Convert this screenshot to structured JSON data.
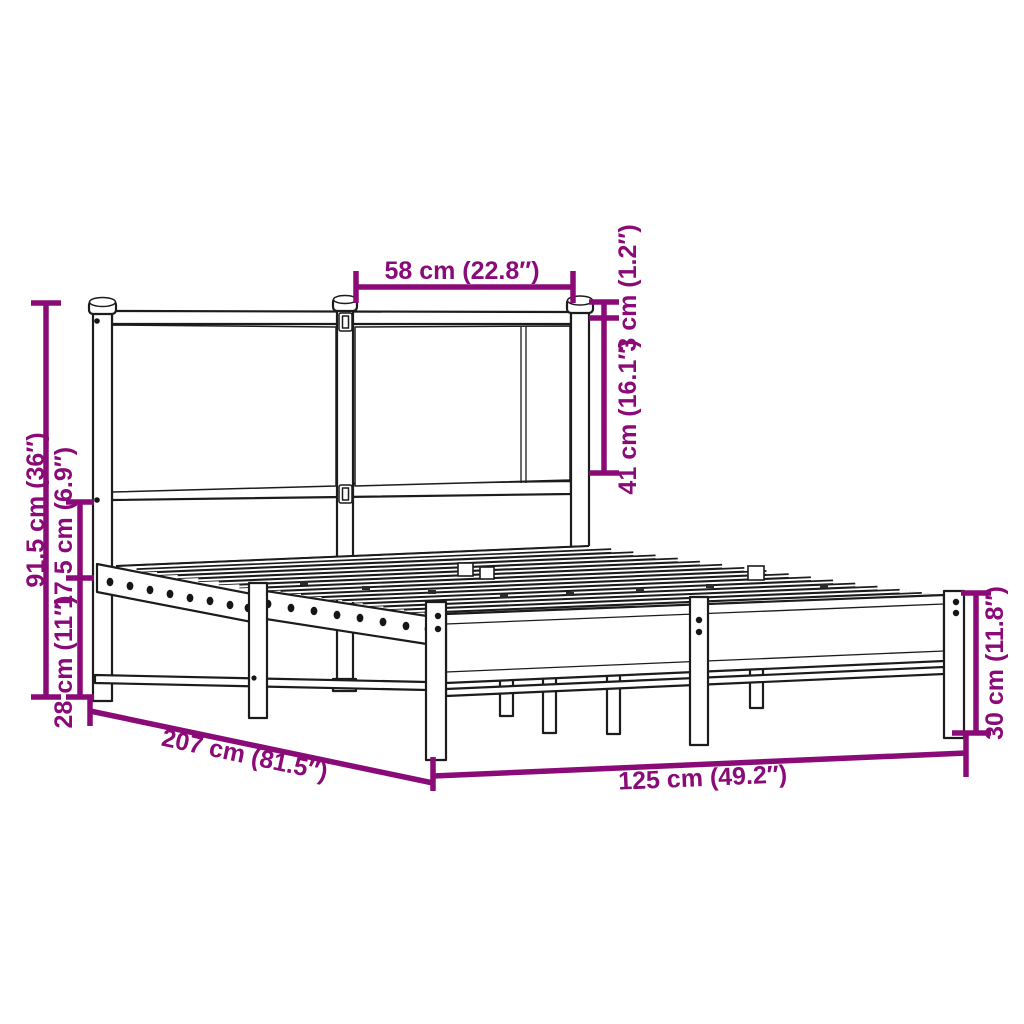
{
  "diagram": {
    "dimensions": {
      "headboard_section_width": "58 cm (22.8″)",
      "top_rail_thickness": "3 cm (1.2″)",
      "headboard_panel_height": "41 cm (16.1″)",
      "headboard_height": "91,5 cm (36″)",
      "rail_to_headboard_gap": "17,5 cm (6.9″)",
      "under_bed_clearance": "28 cm (11″)",
      "bed_length": "207 cm (81.5″)",
      "bed_width": "125 cm (49.2″)",
      "footboard_height": "30 cm (11.8″)"
    },
    "colors": {
      "dimension_accent": "#8A0B78",
      "outline": "#1C1C1C",
      "background": "#FFFFFF"
    }
  }
}
